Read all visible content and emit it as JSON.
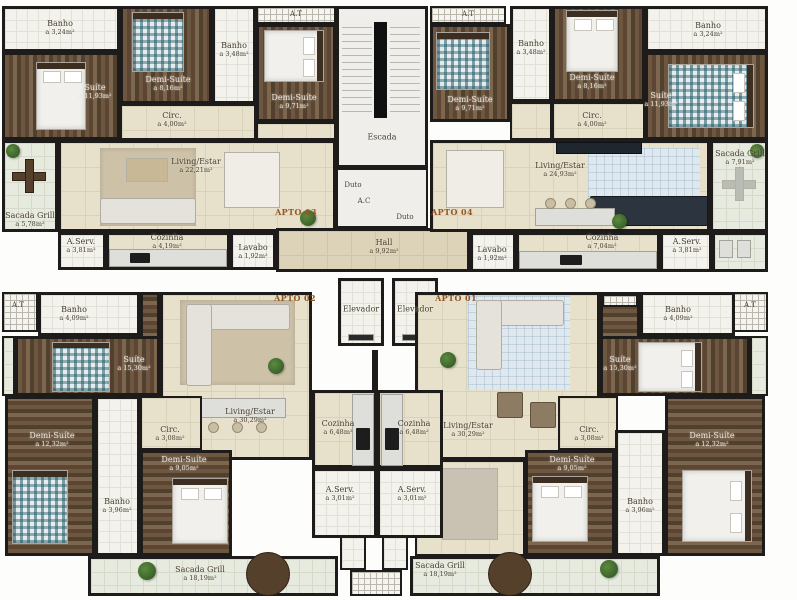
{
  "core": {
    "escada": "Escada",
    "duto1": "Duto",
    "duto2": "Duto",
    "ac": "A.C",
    "hall": {
      "name": "Hall",
      "area": "a 9,92m²"
    },
    "elevador1": "Elevador",
    "elevador2": "Elevador",
    "at_tl": "A.T",
    "at_tr": "A.T",
    "at_bl": "A.T",
    "at_br": "A.T"
  },
  "apto03": {
    "label": "APTO 03",
    "rooms": {
      "banho1": {
        "name": "Banho",
        "area": "a 3,24m²"
      },
      "suite": {
        "name": "Suíte",
        "area": "a 11,93m²"
      },
      "demi1": {
        "name": "Demi-Suíte",
        "area": "a 8,16m²"
      },
      "banho2": {
        "name": "Banho",
        "area": "a 3,48m²"
      },
      "demi2": {
        "name": "Demi-Suíte",
        "area": "a 9,71m²"
      },
      "circ": {
        "name": "Circ.",
        "area": "a 4,00m²"
      },
      "living": {
        "name": "Living/Estar",
        "area": "a 22,21m²"
      },
      "sacada": {
        "name": "Sacada Grill",
        "area": "a 5,78m²"
      },
      "aserv": {
        "name": "A.Serv.",
        "area": "a 3,81m²"
      },
      "cozinha": {
        "name": "Cozinha",
        "area": "a 4,19m²"
      },
      "lavabo": {
        "name": "Lavabo",
        "area": "a 1,92m²"
      }
    }
  },
  "apto04": {
    "label": "APTO 04",
    "rooms": {
      "demi1": {
        "name": "Demi-Suíte",
        "area": "a 9,71m²"
      },
      "banho1": {
        "name": "Banho",
        "area": "a 3,48m²"
      },
      "demi2": {
        "name": "Demi-Suíte",
        "area": "a 8,16m²"
      },
      "banho2": {
        "name": "Banho",
        "area": "a 3,24m²"
      },
      "suite": {
        "name": "Suíte",
        "area": "a 11,93m²"
      },
      "circ": {
        "name": "Circ.",
        "area": "a 4,00m²"
      },
      "living": {
        "name": "Living/Estar",
        "area": "a 24,93m²"
      },
      "sacada": {
        "name": "Sacada Grill",
        "area": "a 7,91m²"
      },
      "lavabo": {
        "name": "Lavabo",
        "area": "a 1,92m²"
      },
      "cozinha": {
        "name": "Cozinha",
        "area": "a 7,04m²"
      },
      "aserv": {
        "name": "A.Serv.",
        "area": "a 3,81m²"
      }
    }
  },
  "apto02": {
    "label": "APTO 02",
    "rooms": {
      "banho1": {
        "name": "Banho",
        "area": "a 4,09m²"
      },
      "suite": {
        "name": "Suíte",
        "area": "a 15,30m²"
      },
      "circ": {
        "name": "Circ.",
        "area": "a 3,08m²"
      },
      "demi1": {
        "name": "Demi-Suíte",
        "area": "a 12,32m²"
      },
      "banho2": {
        "name": "Banho",
        "area": "a 3,96m²"
      },
      "demi2": {
        "name": "Demi-Suíte",
        "area": "a 9,05m²"
      },
      "living": {
        "name": "Living/Estar",
        "area": "a 30,29m²"
      },
      "cozinha": {
        "name": "Cozinha",
        "area": "a 6,48m²"
      },
      "aserv": {
        "name": "A.Serv.",
        "area": "a 3,01m²"
      },
      "sacada": {
        "name": "Sacada Grill",
        "area": "a 18,19m²"
      }
    }
  },
  "apto01": {
    "label": "APTO 01",
    "rooms": {
      "banho1": {
        "name": "Banho",
        "area": "a 4,09m²"
      },
      "suite": {
        "name": "Suíte",
        "area": "a 15,30m²"
      },
      "circ": {
        "name": "Circ.",
        "area": "a 3,08m²"
      },
      "demi1": {
        "name": "Demi-Suíte",
        "area": "a 9,05m²"
      },
      "banho2": {
        "name": "Banho",
        "area": "a 3,96m²"
      },
      "demi2": {
        "name": "Demi-Suíte",
        "area": "a 12,32m²"
      },
      "living": {
        "name": "Living/Estar",
        "area": "a 30,29m²"
      },
      "cozinha": {
        "name": "Cozinha",
        "area": "a 6,48m²"
      },
      "aserv": {
        "name": "A.Serv.",
        "area": "a 3,01m²"
      },
      "sacada": {
        "name": "Sacada Grill",
        "area": "a 18,19m²"
      }
    }
  }
}
